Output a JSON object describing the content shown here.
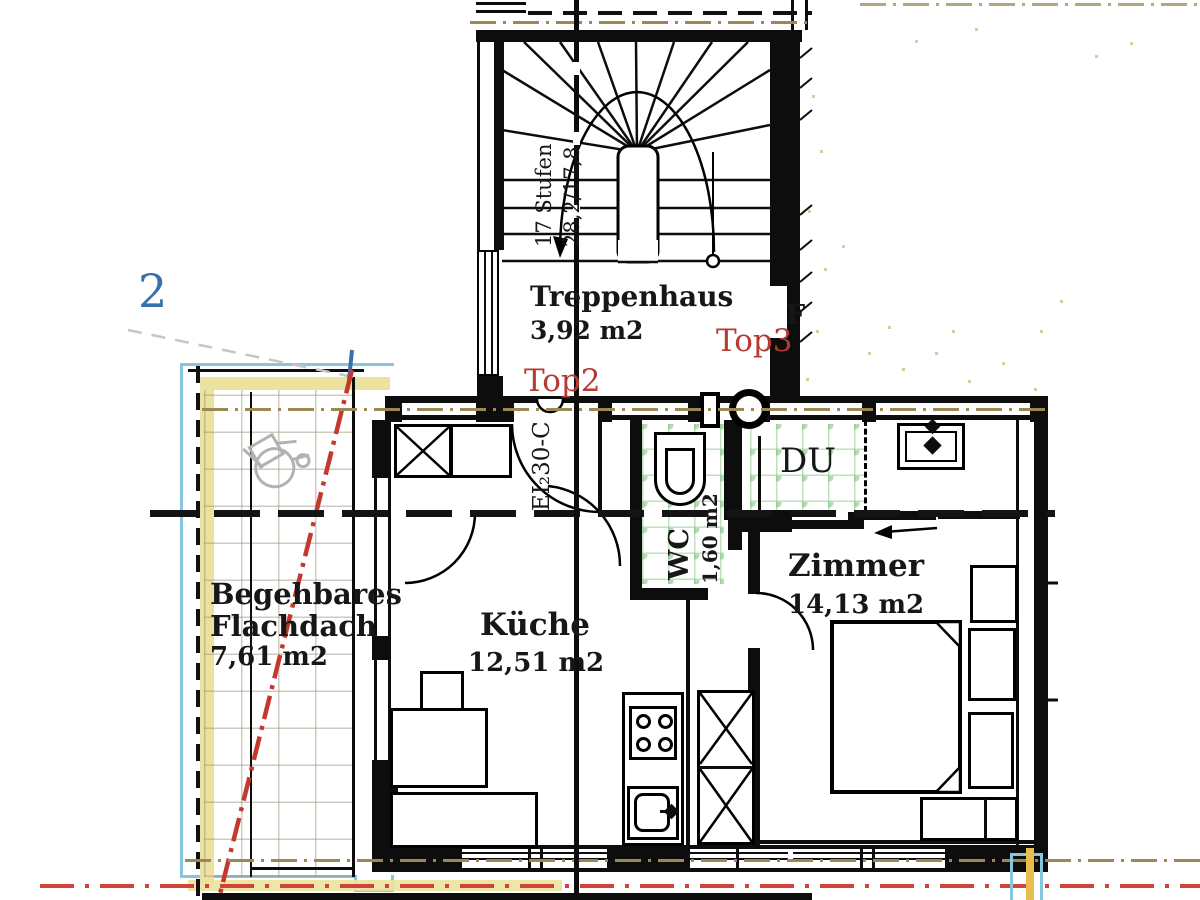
{
  "plan": {
    "rooms": {
      "treppenhaus": {
        "name": "Treppenhaus",
        "area": "3,92 m2"
      },
      "kueche": {
        "name": "Küche",
        "area": "12,51 m2"
      },
      "zimmer": {
        "name": "Zimmer",
        "area": "14,13 m2"
      },
      "wc": {
        "name": "WC",
        "area": "1,60 m2"
      },
      "du": {
        "name": "DU"
      },
      "flachdach": {
        "name_line1": "Begehbares",
        "name_line2": "Flachdach",
        "area": "7,61 m2"
      }
    },
    "units": {
      "top2": "Top2",
      "top3": "Top3"
    },
    "stair": {
      "steps": "17 Stufen",
      "dimensions": "28,2/17,8"
    },
    "door_rating": "EI₂30-C",
    "partials": {
      "letter_f": "F",
      "digit_two": "2"
    },
    "colors": {
      "label_red": "#b43a32",
      "line_red": "#cf4338",
      "tan_dashdot": "#9a8a52",
      "cyan_line": "#86c7df",
      "yellow_band": "#ece29f",
      "yellow_line": "#e7bd4e",
      "blue_digit": "#3a6fae",
      "tile_green": "#8cc98c",
      "wall_black": "#0d0d0d"
    }
  }
}
